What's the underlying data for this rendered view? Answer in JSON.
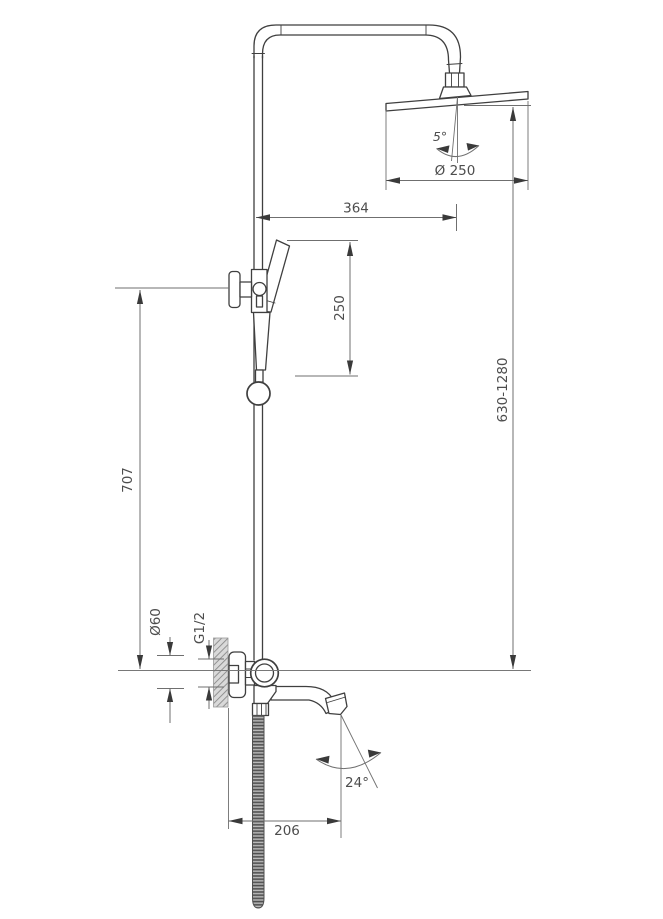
{
  "style": {
    "background": "#ffffff",
    "object_line_color": "#3f3f3f",
    "dimension_line_color": "#6f6f6f",
    "arrow_color": "#3a3a3a",
    "text_color": "#4d4d4d",
    "hatch_color": "#8a8a8a",
    "hose_fill_color": "#7d7d7d"
  },
  "dimensions": {
    "top_offset": "364",
    "head_diameter": "Ø 250",
    "head_tilt_angle": "5°",
    "hand_shower_travel": "250",
    "bar_height": "707",
    "adjustable_height_range": "630-1280",
    "escutcheon_diameter": "Ø60",
    "connection_thread": "G1/2",
    "spout_angle": "24°",
    "spout_reach": "206"
  }
}
